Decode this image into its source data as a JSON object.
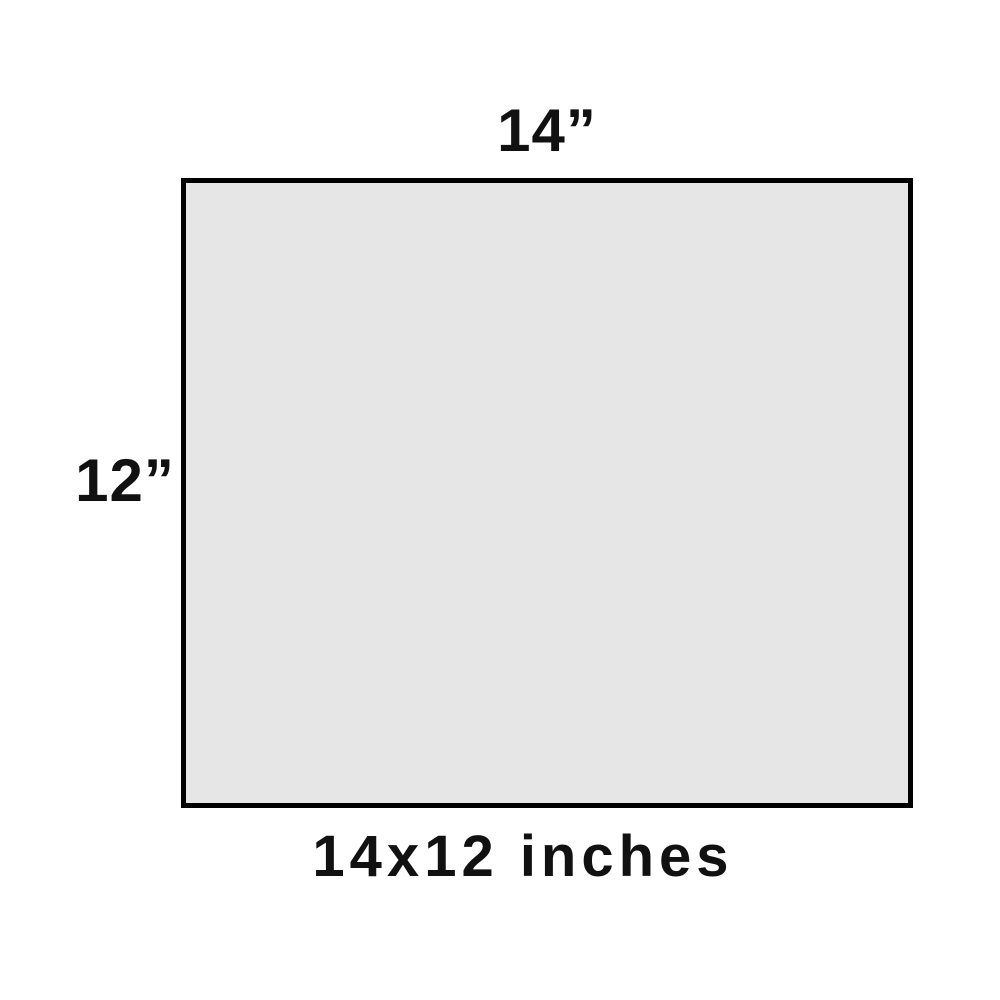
{
  "diagram": {
    "width_label": "14”",
    "height_label": "12”",
    "caption": "14x12 inches",
    "colors": {
      "background": "#ffffff",
      "rect_fill": "#e6e6e6",
      "rect_border": "#000000",
      "text": "#111111"
    }
  }
}
